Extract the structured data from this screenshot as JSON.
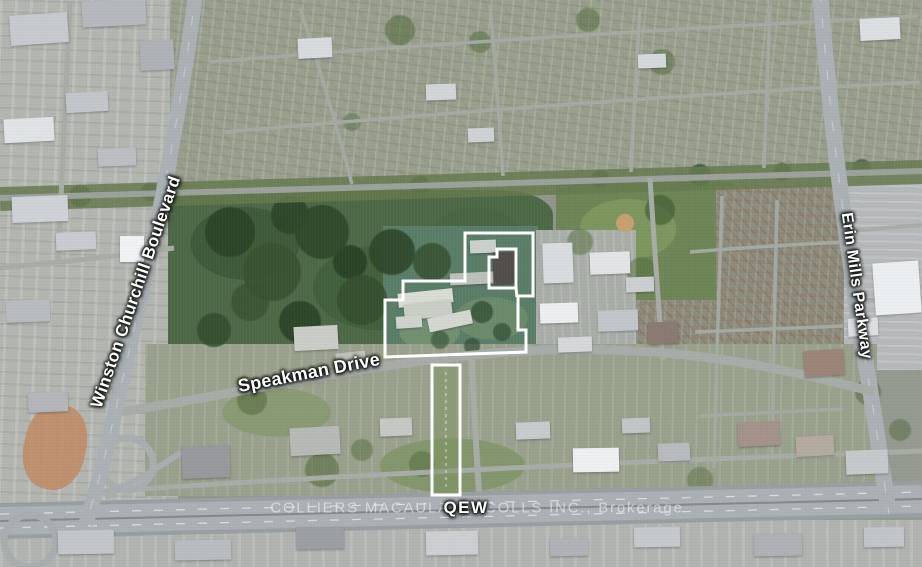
{
  "map": {
    "labels": {
      "winston_churchill": "Winston Churchill Boulevard",
      "speakman": "Speakman Drive",
      "erin_mills": "Erin Mills Parkway",
      "qew": "QEW"
    },
    "watermark": "COLLIERS MACAULAY NICOLLS INC., Brokerage",
    "colors": {
      "parcel_outline": "#ffffff",
      "label_text": "#ffffff"
    }
  }
}
